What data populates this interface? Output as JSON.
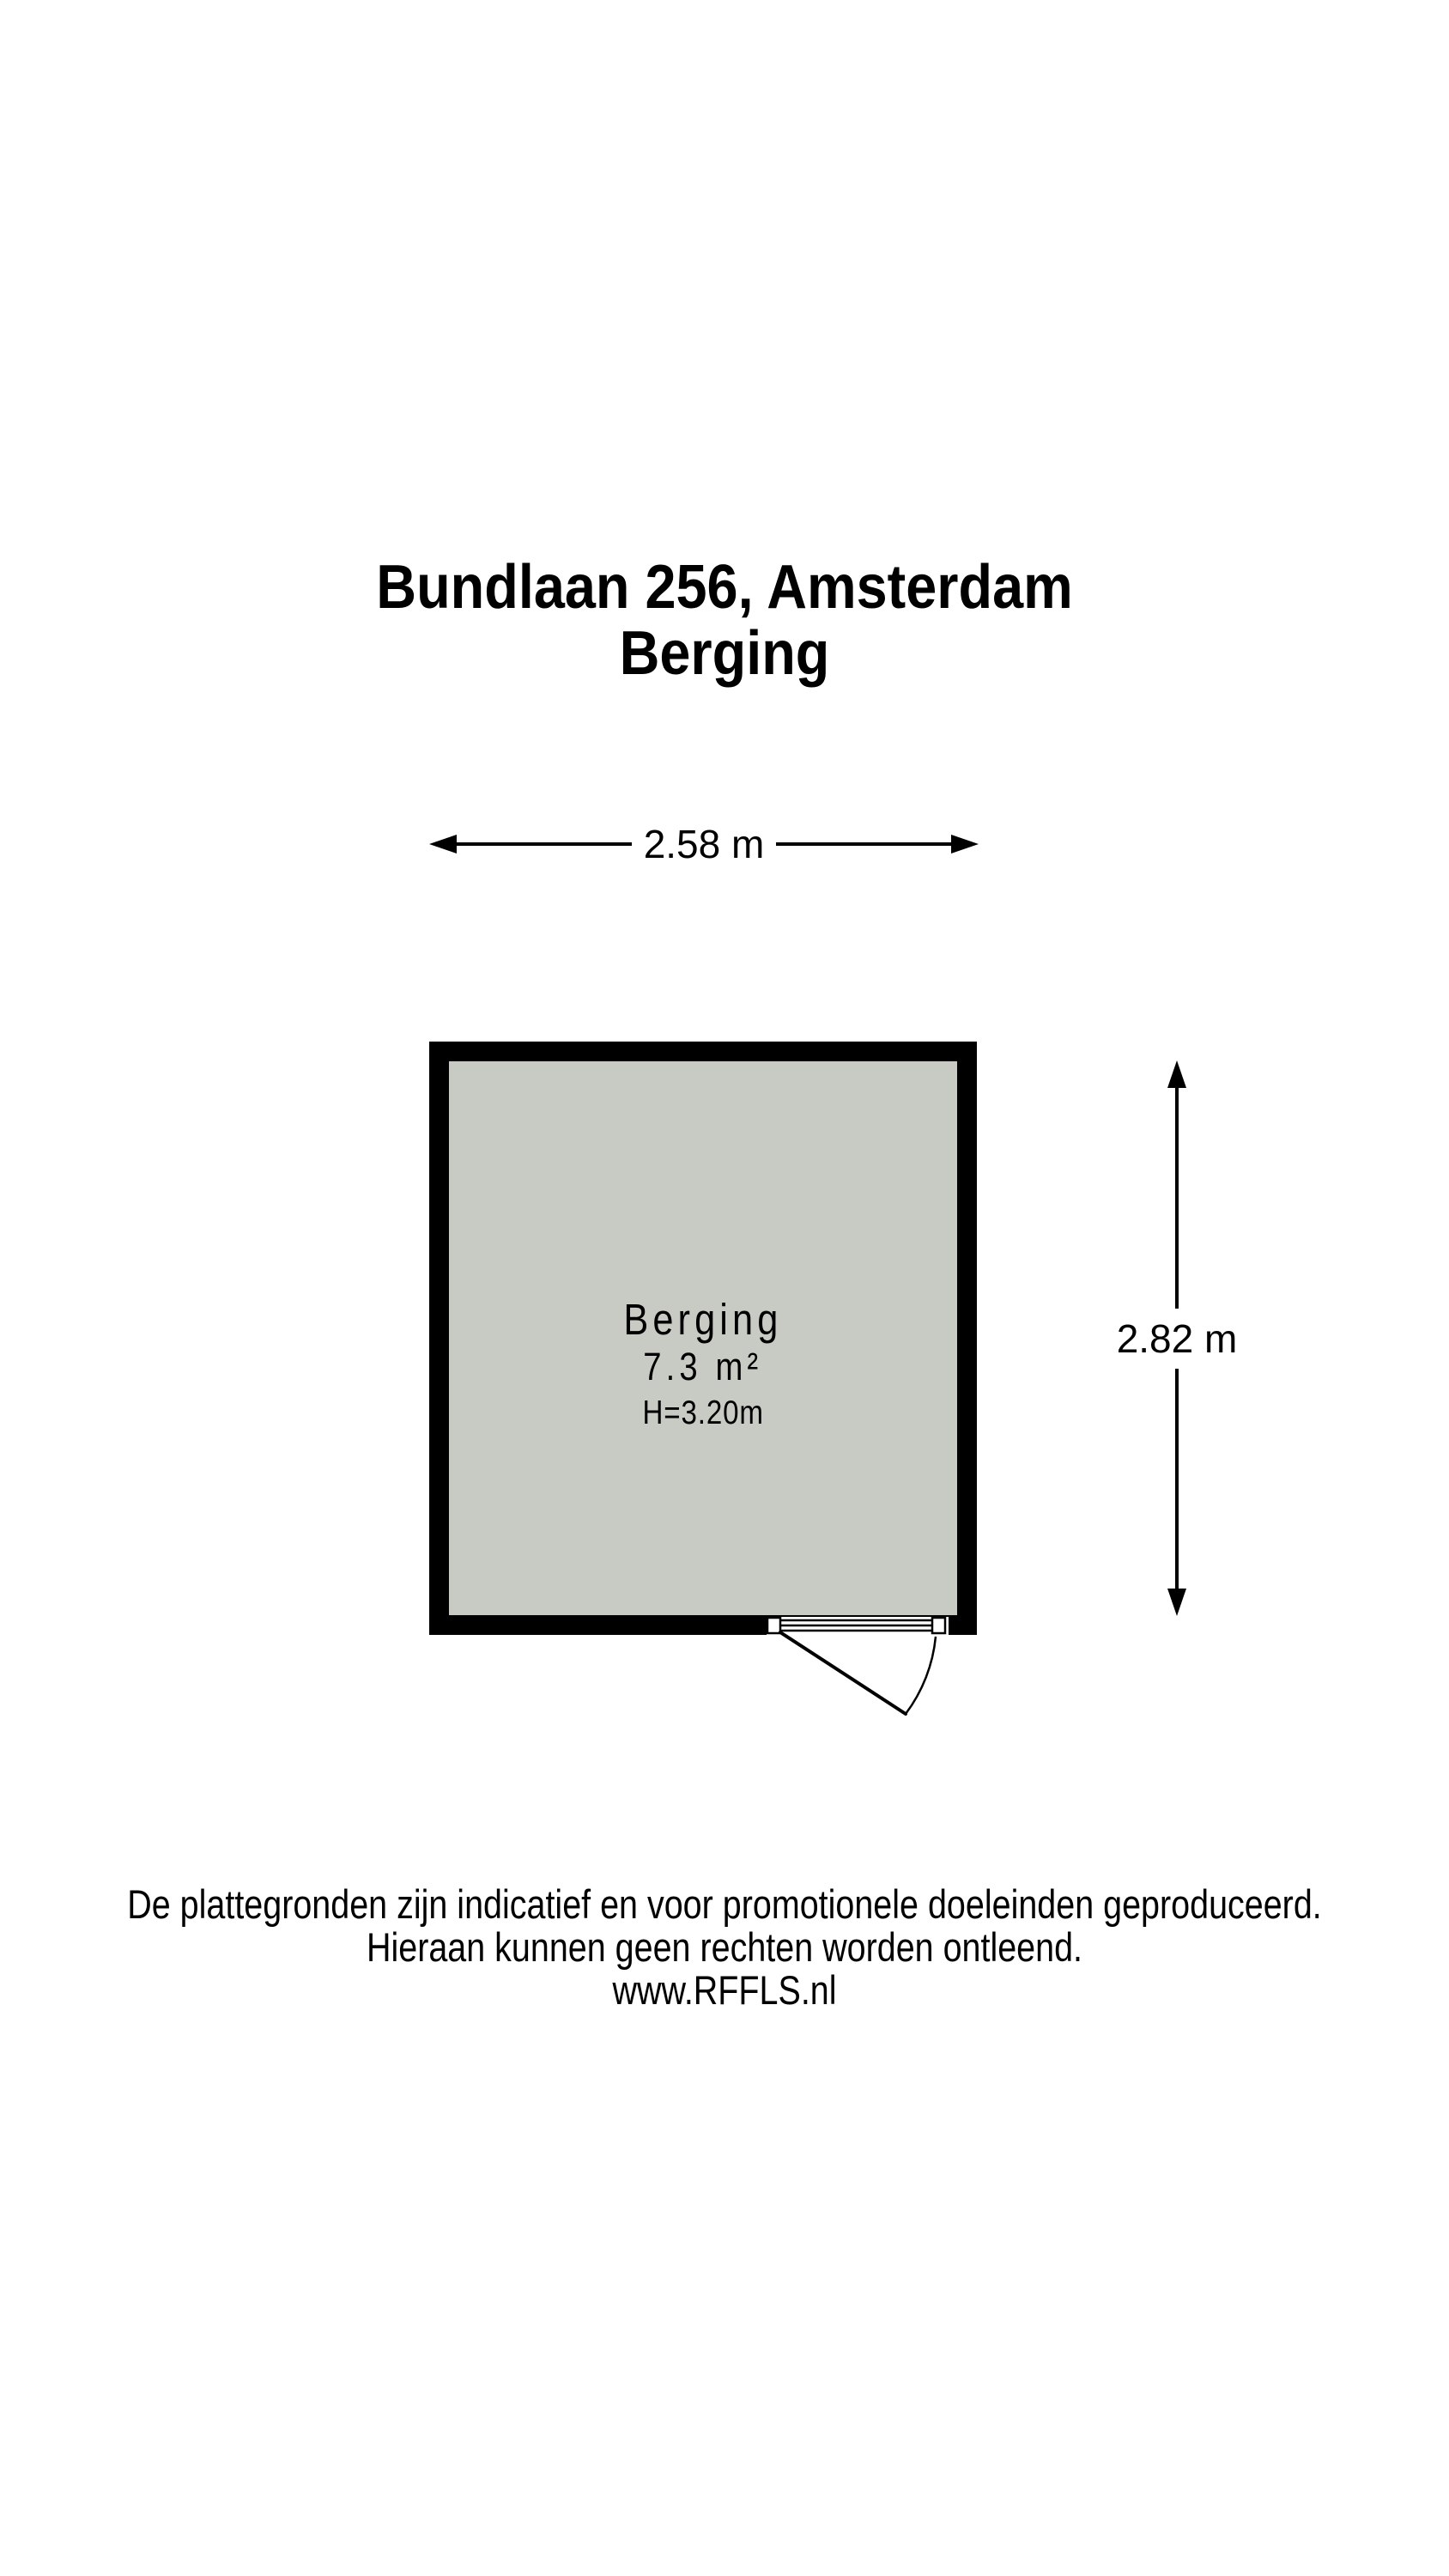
{
  "page": {
    "background_color": "#ffffff"
  },
  "title": {
    "line1": "Bundlaan 256, Amsterdam",
    "line2": "Berging"
  },
  "floorplan": {
    "room": {
      "name": "Berging",
      "area": "7.3 m²",
      "ceiling_height": "H=3.20m",
      "fill_color": "#c8cac4",
      "wall_color": "#000000"
    },
    "dimensions": {
      "width": "2.58 m",
      "height": "2.82 m"
    }
  },
  "footer": {
    "lines": [
      "De plattegronden zijn indicatief en voor promotionele doeleinden geproduceerd.",
      "Hieraan kunnen geen rechten worden ontleend.",
      "www.RFFLS.nl"
    ]
  }
}
